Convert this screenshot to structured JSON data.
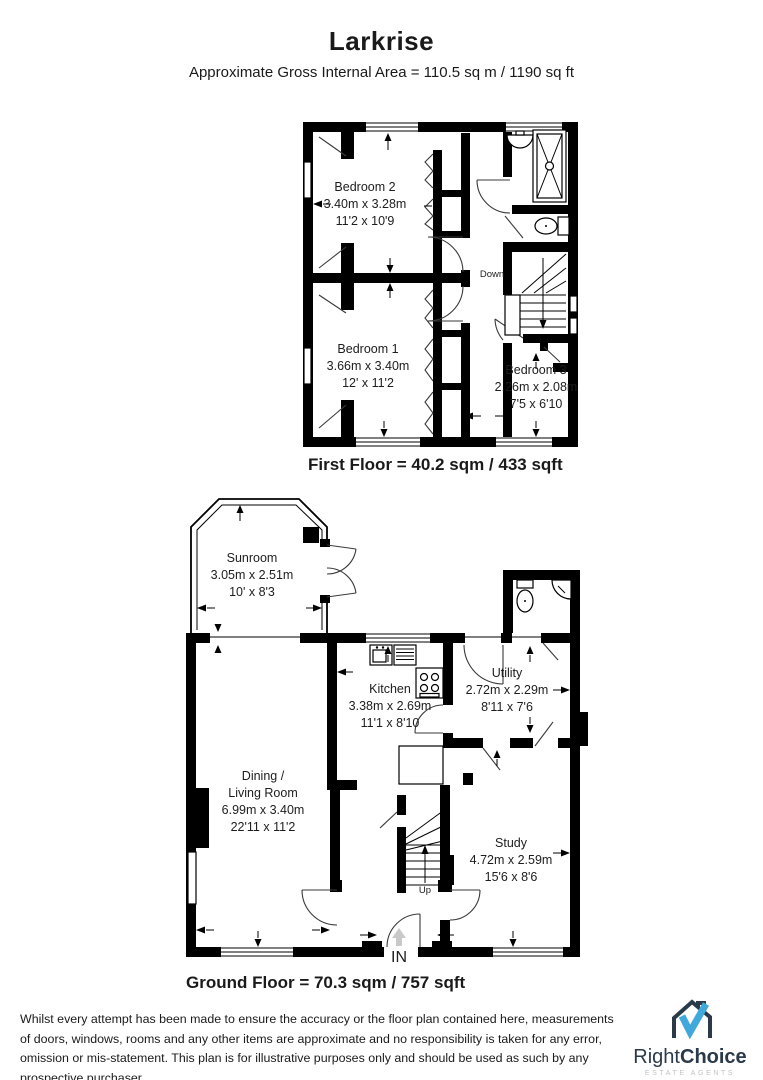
{
  "page": {
    "title": "Larkrise",
    "subtitle": "Approximate Gross Internal Area = 110.5 sq m / 1190 sq ft"
  },
  "first_floor": {
    "caption": "First Floor = 40.2 sqm / 433 sqft",
    "stairs_label": "Down",
    "rooms": {
      "bedroom2": {
        "name": "Bedroom 2",
        "metric": "3.40m x 3.28m",
        "imperial": "11'2 x 10'9"
      },
      "bedroom1": {
        "name": "Bedroom 1",
        "metric": "3.66m x 3.40m",
        "imperial": "12' x 11'2"
      },
      "bedroom3": {
        "name": "Bedroom 3",
        "metric": "2.26m x 2.08m",
        "imperial": "7'5 x 6'10"
      }
    }
  },
  "ground_floor": {
    "caption": "Ground Floor = 70.3 sqm / 757 sqft",
    "stairs_label": "Up",
    "entrance_label": "IN",
    "rooms": {
      "sunroom": {
        "name": "Sunroom",
        "metric": "3.05m x 2.51m",
        "imperial": "10' x 8'3"
      },
      "kitchen": {
        "name": "Kitchen",
        "metric": "3.38m x 2.69m",
        "imperial": "11'1 x 8'10"
      },
      "utility": {
        "name": "Utility",
        "metric": "2.72m x 2.29m",
        "imperial": "8'11 x 7'6"
      },
      "dining_living": {
        "name_line1": "Dining /",
        "name_line2": "Living Room",
        "metric": "6.99m x 3.40m",
        "imperial": "22'11 x 11'2"
      },
      "study": {
        "name": "Study",
        "metric": "4.72m x 2.59m",
        "imperial": "15'6 x 8'6"
      }
    }
  },
  "disclaimer": "Whilst every attempt has been made to ensure the accuracy or the floor plan contained here, measurements of doors, windows, rooms and any other items are approximate and no responsibility is taken for any error, omission or mis-statement. This plan is for illustrative purposes only and should be used as such by any prospective purchaser.",
  "logo": {
    "brand_regular": "Right",
    "brand_bold": "Choice",
    "tagline": "ESTATE AGENTS",
    "colors": {
      "house": "#2b3a49",
      "check": "#41a8dc",
      "tagline_gray": "#c0c3c6"
    }
  }
}
